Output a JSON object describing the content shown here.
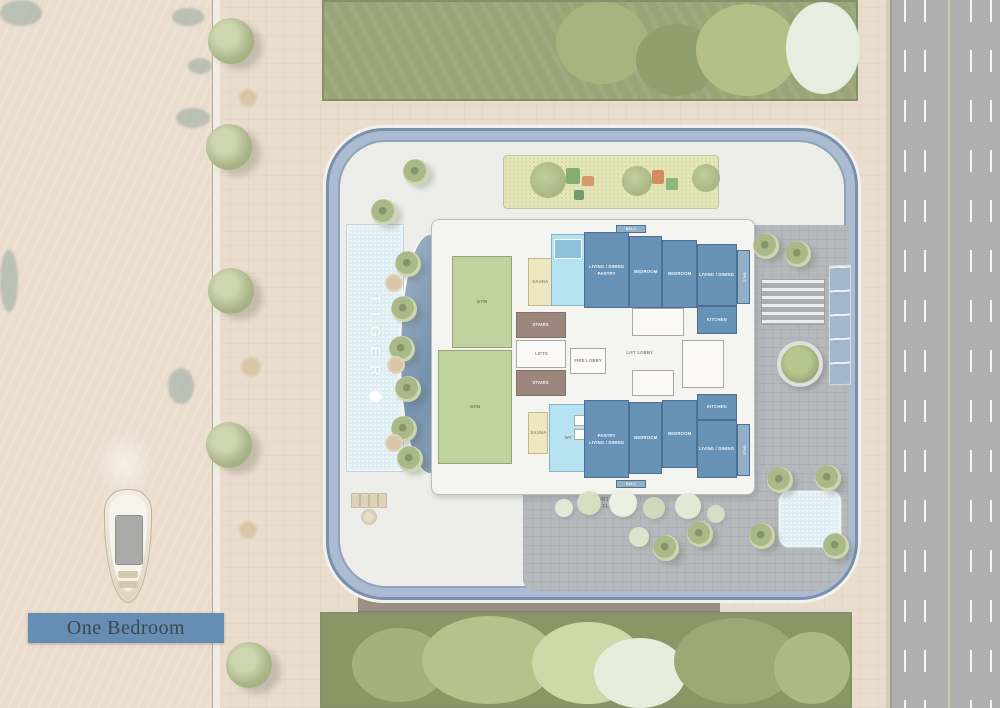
{
  "badge": {
    "label": "One Bedroom"
  },
  "pool": {
    "watermark": "TIGER"
  },
  "courtyard": {
    "line1": "COURTYARD",
    "line2": "1st FLOOR"
  },
  "labels": {
    "gym": "GYM",
    "sauna": "SAUNA",
    "living_dining": "LIVING / DINING",
    "bedroom": "BEDROOM",
    "kitchen": "KITCHEN",
    "pantry": "PANTRY",
    "balc": "BALC",
    "stairs": "STAIRS",
    "lifts": "LIFTS",
    "fire_lobby": "FIRE LOBBY",
    "lift_lobby": "LIFT LOBBY",
    "wc": "WC"
  },
  "colors": {
    "water": "#c9e7e0",
    "paving": "#e8d8c6",
    "road": "#a1a1a3",
    "ring_blue": "#9db0ca",
    "unit_blue": "#4d7ea9",
    "amenity_green": "#b6cb8d",
    "sauna_yellow": "#ece3b4",
    "spa_blue": "#abddef",
    "core_brown": "#8c7365",
    "badge_blue": "#4c7aa6"
  }
}
